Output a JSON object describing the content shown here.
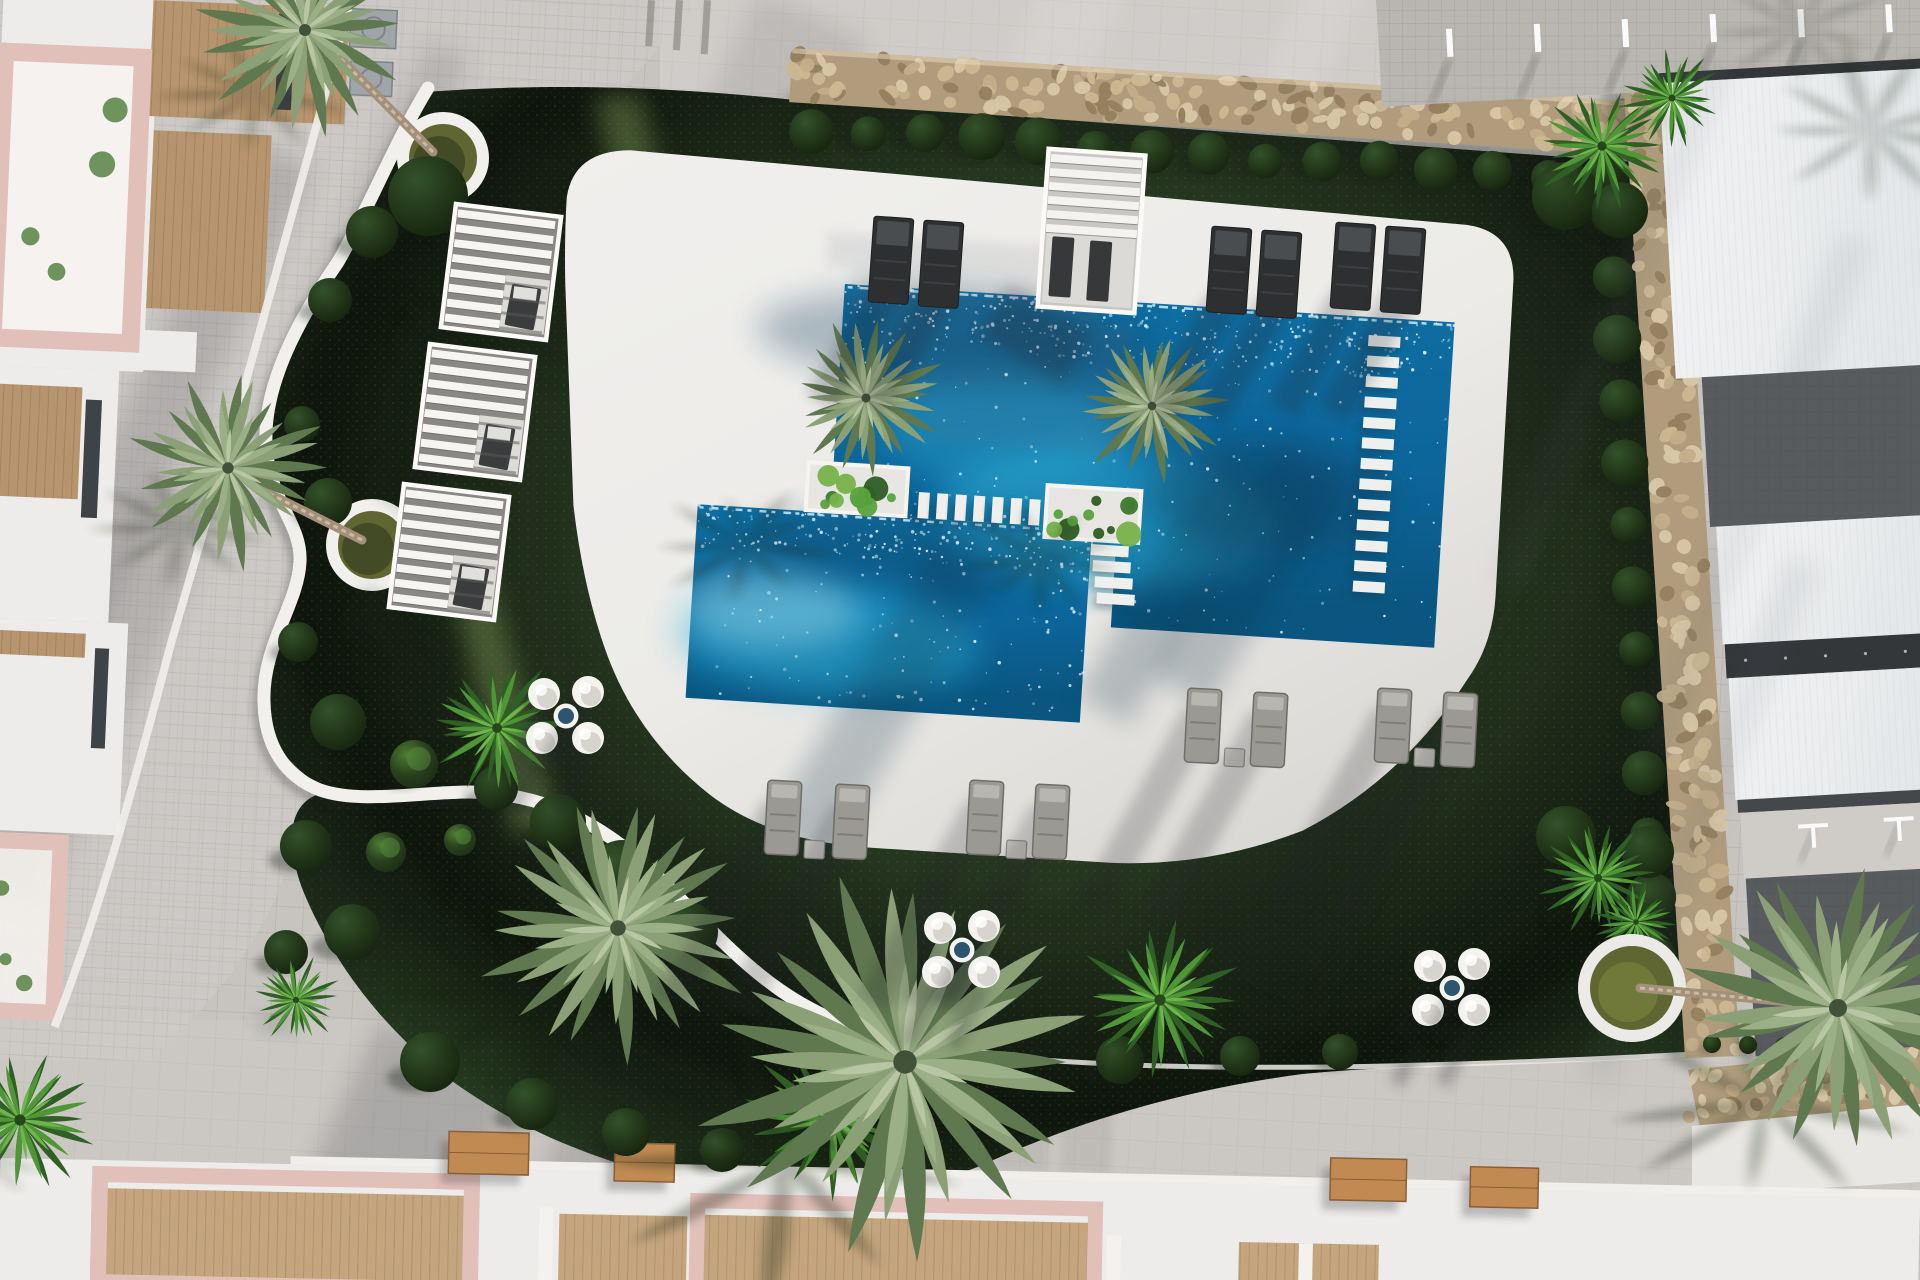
{
  "scene": {
    "title": "Aerial 3D render of residential community pool and landscaped garden",
    "view": "top-down aerial",
    "width": 1920,
    "height": 1280,
    "sun_direction": "top-right",
    "shadow_angle_deg": 25,
    "tilt_deg": 3.6
  },
  "palette": {
    "paving": "#c7c4c0",
    "paving_light": "#d7d4d0",
    "walkway_light": "#cfccc8",
    "tile_line": "#55504a",
    "deck": "#ecebe8",
    "deck_dark": "#d9d7d3",
    "grass": "#47673c",
    "grass_dark": "#2c4527",
    "grass_mid": "#3f5d34",
    "grass_light": "#5e8045",
    "grass_beam": "#8fae62",
    "water": "#0f6fa3",
    "water_deep": "#0a5680",
    "water_aqua": "#2fb3d9",
    "water_pale": "#bfe9f4",
    "sparkle": "#eafaff",
    "wall_base": "#b09c7d",
    "stone_1": "#d8c7a6",
    "stone_2": "#c3ae8b",
    "stone_3": "#94805f",
    "stone_4": "#cbb894",
    "white_wall": "#f1f0ed",
    "bush_hi": "#4d7c35",
    "bush_mid": "#2a421f",
    "bush_lo": "#1d2f15",
    "palm_dark": "#5f7850",
    "palm_mid": "#8ba076",
    "palm_light": "#9cb087",
    "palm_pale": "#b9c6a4",
    "fan_dark": "#2f5f25",
    "fan_mid": "#4f9636",
    "fan_light": "#6fb54b",
    "trunk": "#a3907a",
    "trunk_hi": "#cbbaa0",
    "pink": "#e2c0ba",
    "pink_light": "#eed7d2",
    "wood": "#b6946e",
    "wood_dark": "#9c7a55",
    "bench_wood": "#c08a52",
    "white_bldg": "#edecea",
    "window": "#3e4347",
    "roof_white": "#f2f3f4",
    "roof_shade": "#e3e6e8",
    "eave": "#33373a",
    "terrace_dark": "#585c5e",
    "strip_pale": "#cfccc7",
    "lounger_dark": "#2d2f31",
    "lounger_dark_hi": "#4a4d50",
    "lounger_gray": "#9b9993",
    "lounger_gray_dark": "#6f6d67",
    "pouf": "#f4f3f0",
    "pouf_shade": "#d7d4ce",
    "pouf_table": "#2e5570",
    "planter_soil": "#5f6632",
    "shadow": "#141c12",
    "shadow_cool": "#20242c"
  },
  "pools": {
    "rotate": [
      3.6,
      845,
      282
    ],
    "deck_path": "M562,215 Q566,168 622,164 L1462,186 Q1510,190 1512,238 L1514,555 Q1514,602 1492,638 Q1434,742 1336,801 Q1244,843 1146,845 L905,845 Q806,845 742,802 Q664,748 628,662 Q602,600 588,522 L566,302 Q562,255 562,215 Z",
    "water_big": "M845,284 L1456,284 L1456,610 L1132,610 L1132,532 L1109,532 L1109,513 L845,513 Z",
    "water_small": [
      712,
      513,
      395,
      194
    ],
    "planters": [
      [
        820,
        464,
        100,
        48
      ],
      [
        1060,
        472,
        94,
        52
      ]
    ],
    "bridge": {
      "x0": 932,
      "y": 487,
      "n": 7,
      "w": 11,
      "h": 26,
      "dx": 18.5
    },
    "ladder": {
      "x": 1371,
      "y0": 302,
      "n": 13,
      "w": 32,
      "h": 11,
      "dy": 20.5
    },
    "steps": {
      "x": 1107,
      "y0": 528,
      "n": 4,
      "w": 38,
      "h": 11,
      "dy": 16
    },
    "wall_top": [
      778,
      52,
      848,
      54
    ],
    "bush_row": {
      "x0": 802,
      "x1": 1598,
      "y": 131,
      "n": 15
    },
    "glows": [
      [
        1120,
        500,
        170,
        70,
        "aqua",
        0.45
      ],
      [
        1010,
        420,
        120,
        60,
        "aqua",
        0.35
      ],
      [
        850,
        640,
        150,
        55,
        "aqua",
        0.5
      ],
      [
        790,
        612,
        90,
        40,
        "pale",
        0.35
      ],
      [
        1280,
        470,
        120,
        60,
        "deep",
        0.4
      ],
      [
        960,
        332,
        200,
        48,
        "deep",
        0.3
      ],
      [
        930,
        545,
        170,
        36,
        "deep",
        0.3
      ]
    ],
    "sparkles": {
      "big": 520,
      "small": 300
    },
    "stair_shadows": [
      [
        828,
        232,
        240,
        34
      ],
      [
        852,
        268,
        250,
        40
      ],
      [
        878,
        310,
        255,
        42
      ],
      [
        905,
        354,
        260,
        46
      ],
      [
        930,
        402,
        200,
        40
      ]
    ]
  },
  "garden": {
    "grass_path": "M426,92 C560,82 680,88 795,100 L1632,162 C1648,330 1662,560 1676,760 C1684,880 1690,980 1696,1056 C1560,1064 1430,1062 1302,1074 C1168,1092 1062,1128 980,1166 C898,1198 796,1202 706,1186 C598,1164 516,1128 448,1078 C382,1028 330,958 302,888 C282,832 292,794 332,792 C294,772 266,742 264,702 C262,646 298,604 300,562 C302,522 268,502 266,442 C264,384 298,320 338,262 C368,212 396,142 426,92 Z",
    "wall_path": "M428,88 C396,140 368,210 338,262 C298,320 264,384 266,442 C268,502 302,522 300,562 C298,604 262,646 264,702 C265,745 284,776 320,790 C360,804 420,792 470,792 C530,793 580,812 630,852 C680,892 720,948 780,990 C840,1032 920,1052 1000,1058",
    "curb": "M880,1040 C1080,1078 1380,1070 1694,1054",
    "nooks": [
      {
        "cx": 443,
        "cy": 158,
        "r": 40
      },
      {
        "cx": 372,
        "cy": 545,
        "r": 40
      }
    ],
    "beams": [
      [
        596,
        96,
        640,
        94,
        780,
        650,
        700,
        660
      ],
      [
        430,
        500,
        470,
        498,
        560,
        830,
        515,
        838
      ]
    ],
    "grass_shadow_bands": [
      [
        330,
        40,
        560,
        200,
        0.28
      ],
      [
        1540,
        120,
        170,
        920,
        0.3
      ],
      [
        640,
        820,
        420,
        320,
        0.18
      ],
      [
        240,
        760,
        220,
        320,
        0.2
      ]
    ],
    "bushes": [
      [
        428,
        196,
        40
      ],
      [
        372,
        232,
        26
      ],
      [
        330,
        300,
        22
      ],
      [
        302,
        424,
        18
      ],
      [
        328,
        502,
        24
      ],
      [
        298,
        642,
        20
      ],
      [
        338,
        722,
        28
      ],
      [
        496,
        788,
        22
      ],
      [
        558,
        822,
        28
      ],
      [
        622,
        872,
        32
      ],
      [
        688,
        932,
        30
      ],
      [
        306,
        846,
        26
      ],
      [
        352,
        932,
        28
      ],
      [
        286,
        952,
        22
      ],
      [
        430,
        1062,
        30
      ],
      [
        532,
        1104,
        26
      ],
      [
        626,
        1132,
        24
      ],
      [
        722,
        1150,
        22
      ],
      [
        1120,
        1060,
        24
      ],
      [
        1240,
        1056,
        20
      ],
      [
        1340,
        1052,
        18
      ]
    ],
    "lit_bushes": [
      [
        414,
        764,
        24
      ],
      [
        386,
        852,
        20
      ],
      [
        460,
        840,
        16
      ]
    ],
    "hedge_row": {
      "x0": 1712,
      "y0": 1044,
      "n": 6,
      "dx": 36,
      "dy": 1,
      "r": 9
    }
  },
  "walls_right": {
    "quad": [
      1622,
      60,
      1677,
      60,
      1740,
      1056,
      1685,
      1058
    ],
    "bushes": {
      "n": 13,
      "y0": 215,
      "dy": 62
    },
    "stone_band": [
      1688,
      1070,
      1920,
      1046,
      1920,
      1118,
      1700,
      1128
    ],
    "white_band": [
      1692,
      1126,
      1920,
      1104,
      1920,
      1182,
      1692,
      1196
    ]
  },
  "vegetation": {
    "pool_palms": [
      [
        866,
        398,
        76
      ],
      [
        1152,
        406,
        72
      ]
    ],
    "pool_palm_shadows": [
      [
        745,
        545,
        85
      ],
      [
        1040,
        560,
        80
      ]
    ],
    "palm_streaks": [
      [
        950,
        540,
        70,
        330
      ],
      [
        1230,
        430,
        60,
        280
      ],
      [
        1290,
        420,
        70,
        260
      ]
    ],
    "big_palms": [
      [
        618,
        928,
        130
      ],
      [
        905,
        1062,
        195
      ]
    ],
    "fan_palms": [
      [
        497,
        728,
        70
      ],
      [
        1160,
        1000,
        80
      ],
      [
        832,
        1118,
        84
      ],
      [
        1602,
        146,
        66
      ],
      [
        1672,
        98,
        50
      ],
      [
        1598,
        878,
        58
      ],
      [
        1636,
        922,
        40
      ],
      [
        296,
        1000,
        44
      ],
      [
        20,
        1120,
        80
      ]
    ],
    "corner_bushes": [
      [
        1566,
        196,
        34
      ],
      [
        1620,
        210,
        28
      ],
      [
        1566,
        836,
        30
      ],
      [
        1648,
        852,
        26
      ]
    ],
    "nook_palms": [
      {
        "canopy": [
          305,
          30,
          100
        ],
        "trunk": [
          433,
          152,
          330,
          48
        ]
      },
      {
        "canopy": [
          228,
          468,
          95
        ],
        "trunk": [
          362,
          540,
          258,
          488
        ]
      }
    ],
    "right_palm": {
      "canopy": [
        1838,
        1008,
        150
      ],
      "trunk": [
        1640,
        988,
        1790,
        1002
      ]
    }
  },
  "furniture": {
    "cabanas": [
      [
        448,
        210
      ],
      [
        422,
        350
      ],
      [
        396,
        490
      ]
    ],
    "cabana_size": [
      106,
      124,
      7
    ],
    "pergola": [
      1043,
      152,
      97,
      158,
      4
    ],
    "dark_pairs": [
      [
        874,
        216
      ],
      [
        1212,
        226
      ],
      [
        1336,
        222
      ]
    ],
    "gray_rows": [
      {
        "y": 780,
        "xs": [
          768,
          836,
          970,
          1036
        ]
      },
      {
        "y": 688,
        "xs": [
          1188,
          1254,
          1378,
          1444
        ]
      }
    ],
    "pouf_sets": [
      [
        566,
        716
      ],
      [
        962,
        950
      ],
      [
        1452,
        988
      ]
    ]
  },
  "buildings": {
    "top_left": {
      "rot": [
        2.5,
        150,
        80
      ],
      "white": [
        [
          0,
          0,
          156,
          372
        ],
        [
          0,
          372,
          132,
          252
        ],
        [
          0,
          624,
          152,
          212
        ],
        [
          148,
          330,
          60,
          40
        ]
      ],
      "wood": [
        [
          150,
          0,
          196,
          116
        ],
        [
          156,
          130,
          118,
          178
        ],
        [
          0,
          390,
          96,
          112
        ],
        [
          0,
          636,
          110,
          24
        ]
      ],
      "pink_frames": [
        [
          4,
          58,
          138,
          286,
          18
        ],
        [
          0,
          846,
          94,
          170,
          16
        ]
      ],
      "windows": [
        [
          276,
          8,
          16,
          96
        ],
        [
          100,
          402,
          16,
          118
        ],
        [
          120,
          650,
          14,
          100
        ]
      ],
      "ac": [
        [
          348,
          0,
          46,
          38
        ],
        [
          350,
          52,
          42,
          34
        ]
      ],
      "curb": "M345,0 C300,200 250,420 196,640 C170,760 140,900 96,1030",
      "walkway": "M350,0 L700,0 C560,160 480,260 450,370 C430,470 440,520 420,600 C400,680 330,700 310,780 C290,900 240,980 150,1060 L0,1060 L0,0 Z",
      "walk_steps": [
        [
          556,
          160,
          692,
          142
        ],
        [
          548,
          196,
          688,
          177
        ]
      ],
      "top_steps": [
        [
          648,
          0,
          7,
          46
        ],
        [
          676,
          0,
          7,
          50
        ],
        [
          704,
          0,
          7,
          54
        ]
      ]
    },
    "bottom": {
      "rot": [
        1.2,
        0,
        1180
      ],
      "white_strip": [
        290,
        1150,
        1630,
        44
      ],
      "band": [
        0,
        1158,
        1920,
        130
      ],
      "wood": [
        [
          92,
          1186,
          384,
          94
        ],
        [
          560,
          1202,
          128,
          78
        ],
        [
          698,
          1200,
          400,
          80
        ],
        [
          1240,
          1216,
          140,
          64
        ]
      ],
      "frames": [
        [
          100,
          1172,
          372,
          108,
          16
        ],
        [
          698,
          1186,
          398,
          94,
          15
        ]
      ],
      "slabs": [
        [
          1408,
          1252,
          140,
          28
        ],
        [
          1726,
          1256,
          194,
          24
        ]
      ],
      "dividers": [
        [
          540,
          1196,
          14,
          84
        ],
        [
          690,
          1200,
          14,
          80
        ],
        [
          1108,
          1212,
          14,
          68
        ],
        [
          1300,
          1216,
          14,
          64
        ]
      ],
      "benches": [
        [
          448,
          1122,
          80,
          42
        ],
        [
          614,
          1130,
          60,
          38
        ],
        [
          1330,
          1130,
          76,
          42
        ],
        [
          1470,
          1136,
          68,
          40
        ]
      ],
      "step_strips": [
        [
          878,
          1014,
          52,
          148
        ],
        [
          940,
          1016,
          52,
          150
        ],
        [
          1002,
          1018,
          52,
          152
        ],
        [
          1064,
          1020,
          52,
          152
        ]
      ]
    },
    "right": {
      "rot": [
        -3.2,
        1680,
        60
      ],
      "top_pav": [
        1380,
        -30,
        560,
        120
      ],
      "posts": {
        "x0": 1448,
        "y": 16,
        "n": 6,
        "dx": 88
      },
      "eaveA": [
        1658,
        72,
        262,
        10
      ],
      "bands": [
        [
          "roof",
          1658,
          82,
          262,
          296
        ],
        [
          "terr",
          1684,
          378,
          236,
          150
        ],
        [
          "roof",
          1690,
          528,
          230,
          118
        ],
        [
          "eave",
          1692,
          646,
          228,
          34
        ],
        [
          "roof",
          1694,
          680,
          226,
          122
        ],
        [
          "seam",
          1696,
          802,
          224,
          13
        ],
        [
          "pale",
          1698,
          815,
          222,
          66
        ],
        [
          "terr",
          1700,
          881,
          220,
          178
        ]
      ],
      "tposts": [
        [
          1768,
          830
        ],
        [
          1854,
          828
        ]
      ]
    }
  },
  "light": {
    "top_band_poly": "M660,0 L1920,0 L1920,86 L1395,92 L800,104 L660,96 Z",
    "bottom_band": [
      0,
      1020,
      1920,
      170
    ],
    "sun_streaks": [
      [
        1060,
        -40,
        70,
        260
      ],
      [
        1320,
        -40,
        50,
        230
      ],
      [
        1520,
        80,
        60,
        400
      ]
    ],
    "shade_bands": [
      [
        760,
        -10,
        120,
        150,
        0.1
      ],
      [
        250,
        140,
        70,
        520,
        0.15
      ],
      [
        430,
        40,
        44,
        320,
        0.12
      ],
      [
        150,
        480,
        80,
        440,
        0.13
      ],
      [
        380,
        1020,
        160,
        260,
        0.18
      ],
      [
        620,
        1000,
        120,
        300,
        0.15
      ],
      [
        1380,
        170,
        240,
        150,
        0.12
      ]
    ]
  }
}
